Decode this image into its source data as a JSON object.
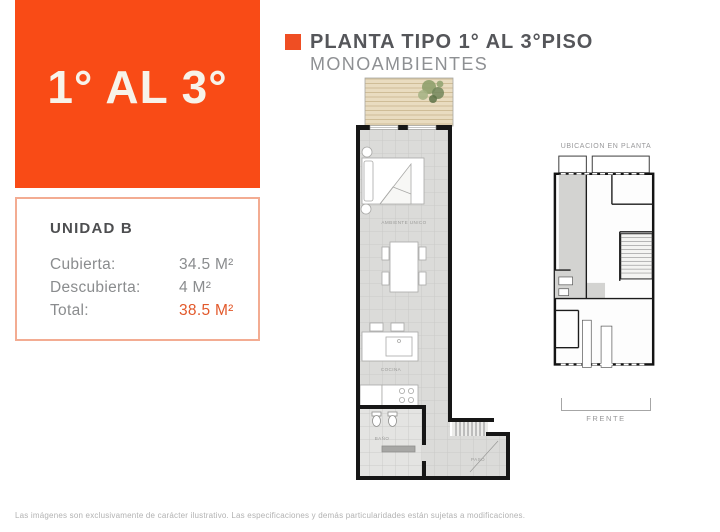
{
  "hero": {
    "label": "1° AL 3°",
    "color": "#f94b16"
  },
  "header": {
    "title": "PLANTA TIPO 1° AL 3°PISO",
    "subtitle": "MONOAMBIENTES",
    "bullet_color": "#ef4e23"
  },
  "unit_card": {
    "title": "UNIDAD B",
    "border_color": "#f3ac92",
    "highlight_color": "#e2592b",
    "rows": [
      {
        "label": "Cubierta:",
        "value": "34.5 M²"
      },
      {
        "label": "Descubierta:",
        "value": "4 M²"
      },
      {
        "label": "Total:",
        "value": "38.5 M²"
      }
    ]
  },
  "floor_plan": {
    "labels": {
      "room": "AMBIENTE UNICO",
      "kitchen": "COCINA",
      "bath": "BAÑO",
      "hall": "PASO"
    }
  },
  "mini_plan": {
    "title": "UBICACION EN PLANTA",
    "caption": "FRENTE"
  },
  "footer": {
    "disclaimer": "Las imágenes son exclusivamente de carácter ilustrativo. Las especificaciones y demás particularidades están sujetas a modificaciones."
  }
}
